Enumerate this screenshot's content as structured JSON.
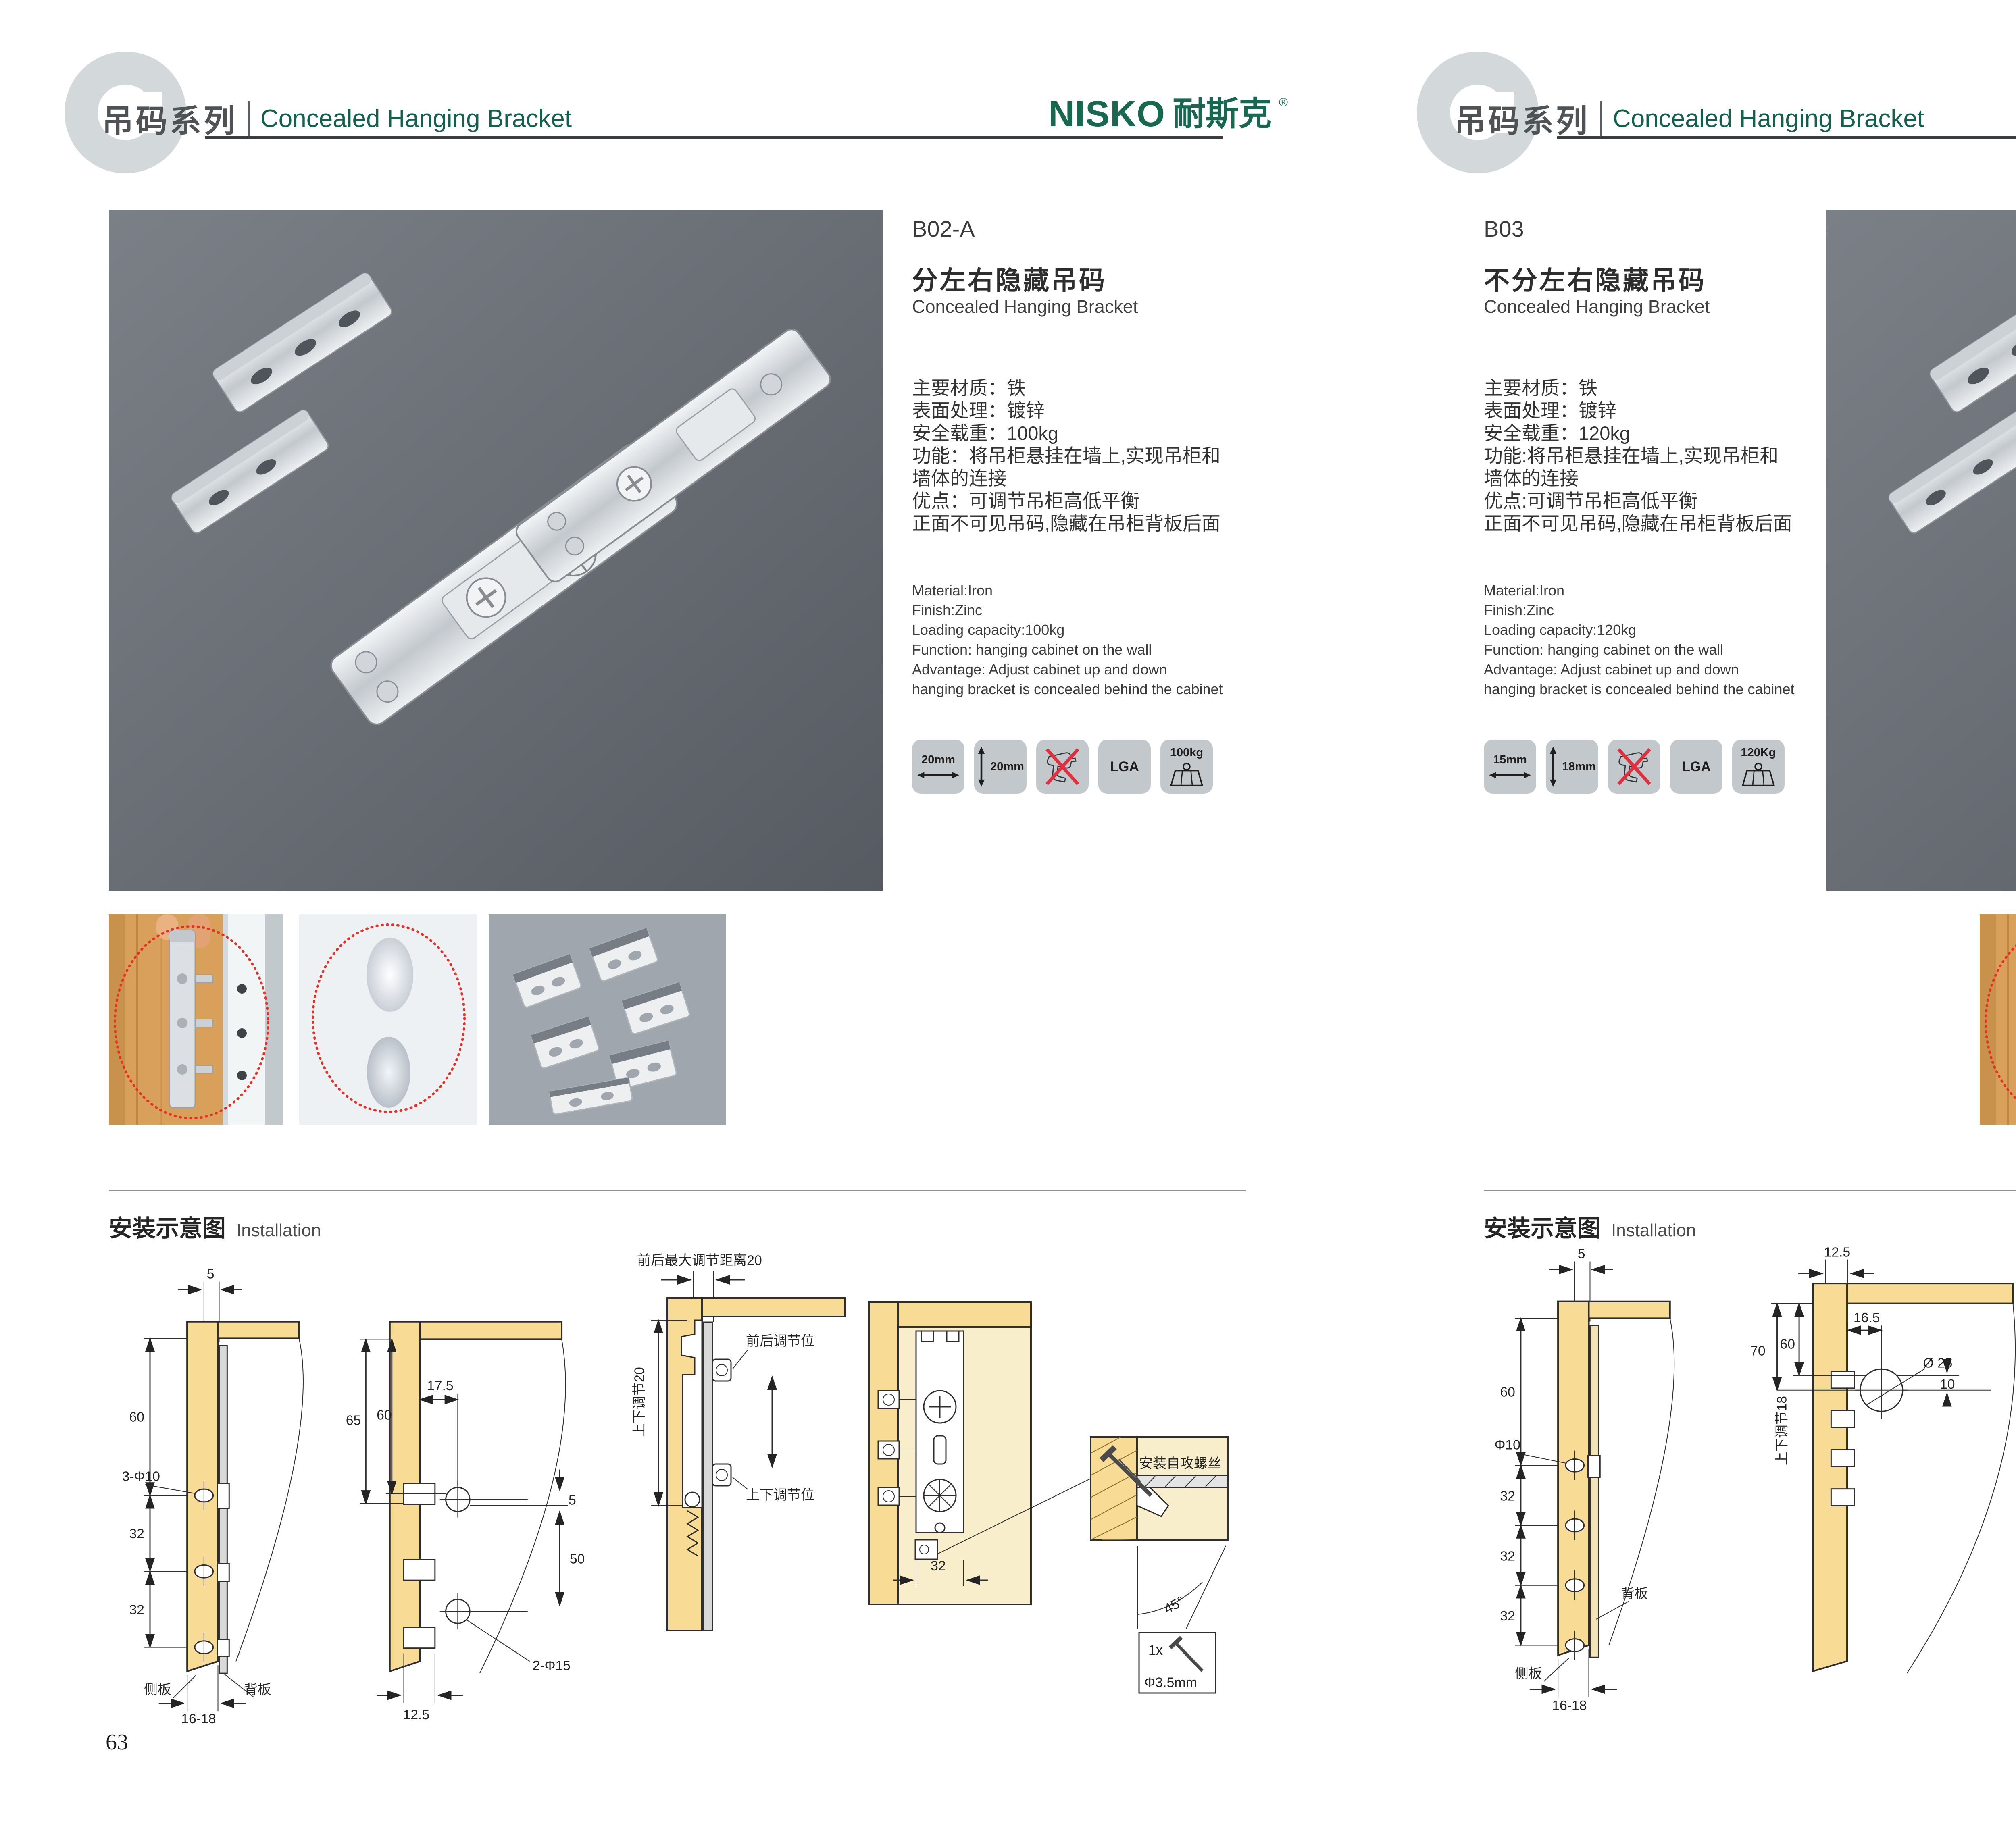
{
  "brand": {
    "latin": "NISKO",
    "cn": "耐斯克",
    "reg": "®"
  },
  "header": {
    "series_cn": "吊码系列",
    "series_en": "Concealed Hanging Bracket"
  },
  "install": {
    "title_cn": "安装示意图",
    "title_en": "Installation"
  },
  "colors": {
    "brand_green": "#15604a",
    "accent_red": "#e53225",
    "diagram_tan": "#f8dc96",
    "photo_bg": "#6a6f76",
    "badge_gray": "#c3c8cd"
  },
  "left": {
    "page_number": "63",
    "code": "B02-A",
    "title_cn": "分左右隐藏吊码",
    "title_en": "Concealed Hanging Bracket",
    "specs_cn": [
      "主要材质：铁",
      "表面处理：镀锌",
      "安全载重：100kg",
      "功能：将吊柜悬挂在墙上,实现吊柜和",
      "墙体的连接",
      "优点：可调节吊柜高低平衡",
      "正面不可见吊码,隐藏在吊柜背板后面"
    ],
    "specs_en": [
      "Material:Iron",
      "Finish:Zinc",
      "Loading capacity:100kg",
      "Function: hanging cabinet on the wall",
      "Advantage: Adjust cabinet up and down",
      "hanging bracket is concealed behind the cabinet"
    ],
    "badges": {
      "width": "20mm",
      "height": "20mm",
      "cert": "LGA",
      "load": "100kg"
    },
    "d1": {
      "top": "5",
      "v1": "60",
      "hole": "3-Φ10",
      "v2": "32",
      "v3": "32",
      "side": "侧板",
      "back": "背板",
      "bottom": "16-18"
    },
    "d2": {
      "v1": "65",
      "v2": "60",
      "top": "17.5",
      "gap": "5",
      "v3": "50",
      "hole": "2-Φ15",
      "bottom": "12.5"
    },
    "d3": {
      "top": "前后最大调节距离20",
      "side": "上下调节20",
      "pos1": "前后调节位",
      "pos2": "上下调节位"
    },
    "d4": {
      "dim": "32",
      "screw": "安装自攻螺丝",
      "angle": "45°",
      "qty": "1x",
      "dia": "Φ3.5mm"
    }
  },
  "right": {
    "page_number": "64",
    "code": "B03",
    "title_cn": "不分左右隐藏吊码",
    "title_en": "Concealed Hanging Bracket",
    "specs_cn": [
      "主要材质：铁",
      "表面处理：镀锌",
      "安全载重：120kg",
      "功能:将吊柜悬挂在墙上,实现吊柜和",
      "墙体的连接",
      "优点:可调节吊柜高低平衡",
      "正面不可见吊码,隐藏在吊柜背板后面"
    ],
    "specs_en": [
      "Material:Iron",
      "Finish:Zinc",
      "Loading capacity:120kg",
      "Function: hanging cabinet on the wall",
      "Advantage: Adjust cabinet up and down",
      "hanging bracket is concealed behind the cabinet"
    ],
    "badges": {
      "width": "15mm",
      "height": "18mm",
      "cert": "LGA",
      "load": "120Kg"
    },
    "d1": {
      "top": "5",
      "v1": "60",
      "hole": "Φ10",
      "v2": "32",
      "v3": "32",
      "v4": "32",
      "back": "背板",
      "side": "侧板",
      "bottom": "16-18"
    },
    "d2": {
      "top": "12.5",
      "v1": "70",
      "v2": "60",
      "h1": "16.5",
      "hole": "Ø 25",
      "gap": "10",
      "side": "上下调节18"
    },
    "d3": {
      "top": "16.5",
      "h1": "12.5",
      "gap": "10",
      "hole": "ø25",
      "state": "锁紧状态",
      "screw": "安装自攻螺丝",
      "angle": "45°",
      "qty": "1x",
      "dia": "Φ3.5mm"
    }
  }
}
